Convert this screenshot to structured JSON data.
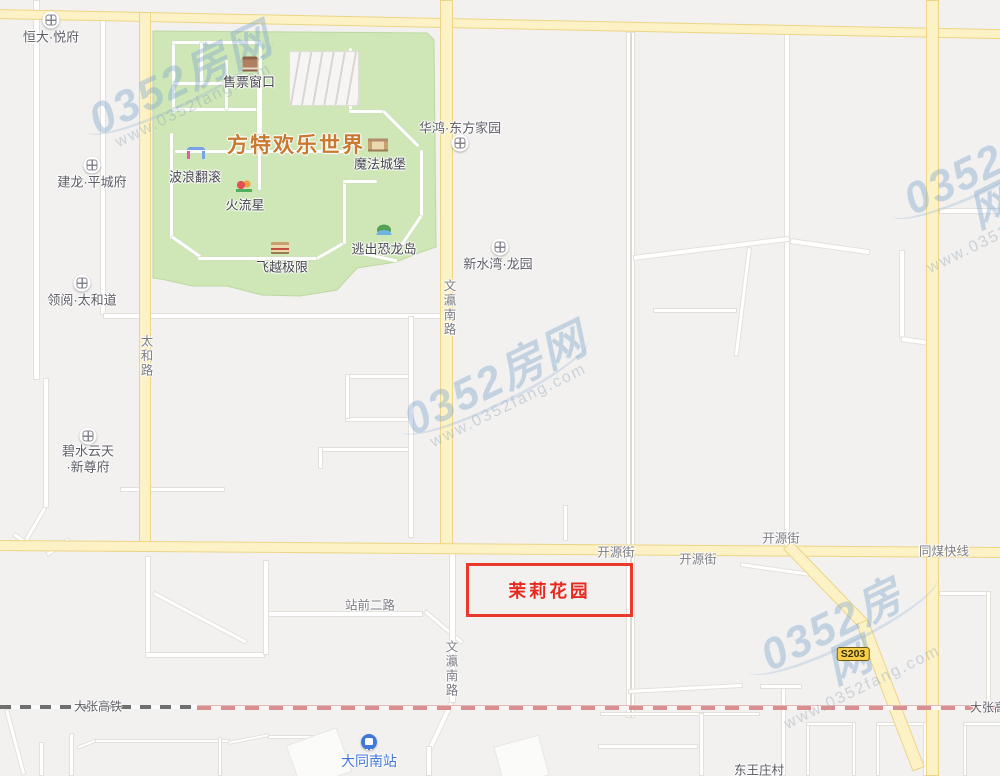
{
  "map": {
    "width": 1000,
    "height": 776,
    "colors": {
      "background": "#f2f1ef",
      "park_green": "#cfe7b6",
      "park_edge": "#bcd8a0",
      "road_yellow": "#fcf2c6",
      "road_yellow_edge": "#ecd587",
      "road_white": "#ffffff",
      "rail_dark": "#6f6f6f",
      "rail_pink": "#d98f8f",
      "highlight_red": "#e8392b",
      "poi_text": "#5c5c66",
      "road_text": "#7c7c84",
      "park_title_orange": "#c8792f",
      "station_blue": "#3f78d8",
      "watermark_blue": "#7da5cd"
    },
    "park": {
      "name": "fantawild-park-area",
      "polygon": "153,31 427,33 434,40 436,247 421,252 396,262 357,268 337,290 300,296 262,295 227,286 192,286 166,280 153,278",
      "parking": {
        "x": 289,
        "y": 51,
        "w": 68,
        "h": 53
      },
      "paths": [
        {
          "d": "v",
          "x": 172,
          "y": 41,
          "l": 72,
          "t": 3
        },
        {
          "d": "h",
          "x": 172,
          "y": 41,
          "l": 90,
          "t": 3
        },
        {
          "d": "v",
          "x": 259,
          "y": 41,
          "l": 48,
          "t": 3
        },
        {
          "d": "h",
          "x": 172,
          "y": 108,
          "l": 90,
          "t": 3
        },
        {
          "d": "v",
          "x": 200,
          "y": 42,
          "l": 42,
          "t": 3
        },
        {
          "d": "h",
          "x": 172,
          "y": 82,
          "l": 56,
          "t": 3
        },
        {
          "d": "v",
          "x": 225,
          "y": 60,
          "l": 50,
          "t": 3
        },
        {
          "d": "v",
          "x": 257,
          "y": 86,
          "l": 48,
          "t": 5
        },
        {
          "d": "v",
          "x": 349,
          "y": 48,
          "l": 64,
          "t": 3
        },
        {
          "d": "h",
          "x": 349,
          "y": 110,
          "l": 34,
          "t": 3
        },
        {
          "d": "v",
          "x": 382,
          "y": 112,
          "l": 50,
          "t": 3,
          "deg": -45
        },
        {
          "d": "v",
          "x": 170,
          "y": 133,
          "l": 106,
          "t": 3
        },
        {
          "d": "v",
          "x": 171,
          "y": 238,
          "l": 35,
          "t": 3,
          "deg": -55
        },
        {
          "d": "h",
          "x": 198,
          "y": 257,
          "l": 120,
          "t": 3
        },
        {
          "d": "h",
          "x": 317,
          "y": 257,
          "l": 30,
          "t": 3,
          "deg": -30
        },
        {
          "d": "v",
          "x": 343,
          "y": 180,
          "l": 64,
          "t": 3
        },
        {
          "d": "h",
          "x": 343,
          "y": 180,
          "l": 34,
          "t": 3
        },
        {
          "d": "v",
          "x": 420,
          "y": 150,
          "l": 67,
          "t": 3
        },
        {
          "d": "v",
          "x": 420,
          "y": 215,
          "l": 39,
          "t": 3,
          "deg": 34
        },
        {
          "d": "h",
          "x": 362,
          "y": 252,
          "l": 36,
          "t": 3,
          "deg": 12
        },
        {
          "d": "h",
          "x": 175,
          "y": 150,
          "l": 175,
          "t": 3
        },
        {
          "d": "v",
          "x": 258,
          "y": 150,
          "l": 40,
          "t": 3
        }
      ]
    },
    "roads_yellow": [
      {
        "name": "north-road",
        "d": "h",
        "x": -4,
        "y": 9,
        "l": 1010,
        "t": 10,
        "deg": 1.15
      },
      {
        "name": "taihe-road",
        "d": "v",
        "x": 139,
        "y": 12,
        "l": 536,
        "t": 12
      },
      {
        "name": "wenying-south-road",
        "d": "v",
        "x": 440,
        "y": 0,
        "l": 551,
        "t": 13
      },
      {
        "name": "tongmei-express-road",
        "d": "v",
        "x": 926,
        "y": 0,
        "l": 776,
        "t": 13
      },
      {
        "name": "kaiyuan-street",
        "d": "h",
        "x": -4,
        "y": 540,
        "l": 1010,
        "t": 11,
        "deg": 0.4
      },
      {
        "name": "s203-road-upper",
        "d": "v",
        "x": 783,
        "y": 549,
        "l": 110,
        "t": 12,
        "deg": -44
      },
      {
        "name": "s203-road-lower",
        "d": "v",
        "x": 856,
        "y": 624,
        "l": 158,
        "t": 13,
        "deg": -21
      }
    ],
    "roads_white": [
      {
        "d": "v",
        "x": 33,
        "y": 0,
        "l": 380,
        "t": 7
      },
      {
        "d": "v",
        "x": 100,
        "y": 20,
        "l": 295,
        "t": 6
      },
      {
        "d": "h",
        "x": 103,
        "y": 313,
        "l": 340,
        "t": 6
      },
      {
        "d": "v",
        "x": 43,
        "y": 378,
        "l": 130,
        "t": 6
      },
      {
        "d": "v",
        "x": 43,
        "y": 506,
        "l": 46,
        "t": 5,
        "deg": 30
      },
      {
        "d": "h",
        "x": 120,
        "y": 487,
        "l": 105,
        "t": 5
      },
      {
        "d": "v",
        "x": 12,
        "y": 536,
        "l": 28,
        "t": 5,
        "deg": -55
      },
      {
        "d": "v",
        "x": 68,
        "y": 537,
        "l": 28,
        "t": 5,
        "deg": 55
      },
      {
        "d": "v",
        "x": 408,
        "y": 316,
        "l": 222,
        "t": 6
      },
      {
        "d": "h",
        "x": 345,
        "y": 374,
        "l": 64,
        "t": 5
      },
      {
        "d": "h",
        "x": 345,
        "y": 417,
        "l": 64,
        "t": 5
      },
      {
        "d": "v",
        "x": 345,
        "y": 374,
        "l": 45,
        "t": 5
      },
      {
        "d": "h",
        "x": 318,
        "y": 447,
        "l": 91,
        "t": 5
      },
      {
        "d": "v",
        "x": 318,
        "y": 447,
        "l": 22,
        "t": 5
      },
      {
        "d": "v",
        "x": 563,
        "y": 505,
        "l": 36,
        "t": 5
      },
      {
        "d": "v",
        "x": 626,
        "y": 32,
        "l": 686,
        "t": 9,
        "dbl": true
      },
      {
        "d": "v",
        "x": 784,
        "y": 33,
        "l": 520,
        "t": 6
      },
      {
        "d": "h",
        "x": 633,
        "y": 255,
        "l": 158,
        "t": 6,
        "deg": -7
      },
      {
        "d": "v",
        "x": 747,
        "y": 247,
        "l": 110,
        "t": 5,
        "deg": 7
      },
      {
        "d": "h",
        "x": 653,
        "y": 308,
        "l": 84,
        "t": 5
      },
      {
        "d": "h",
        "x": 790,
        "y": 238,
        "l": 81,
        "t": 6,
        "deg": 8
      },
      {
        "d": "v",
        "x": 899,
        "y": 250,
        "l": 88,
        "t": 6
      },
      {
        "d": "h",
        "x": 901,
        "y": 336,
        "l": 33,
        "t": 6,
        "deg": 8
      },
      {
        "d": "h",
        "x": 939,
        "y": 208,
        "l": 61,
        "t": 6
      },
      {
        "d": "h",
        "x": 939,
        "y": 591,
        "l": 50,
        "t": 5
      },
      {
        "d": "v",
        "x": 986,
        "y": 591,
        "l": 117,
        "t": 5
      },
      {
        "d": "h",
        "x": 740,
        "y": 562,
        "l": 71,
        "t": 5,
        "deg": 8
      },
      {
        "d": "h",
        "x": 628,
        "y": 689,
        "l": 115,
        "t": 5,
        "deg": -3
      },
      {
        "d": "h",
        "x": 600,
        "y": 712,
        "l": 160,
        "t": 4
      },
      {
        "d": "v",
        "x": 699,
        "y": 713,
        "l": 63,
        "t": 5
      },
      {
        "d": "h",
        "x": 598,
        "y": 744,
        "l": 100,
        "t": 5
      },
      {
        "d": "v",
        "x": 781,
        "y": 684,
        "l": 92,
        "t": 5
      },
      {
        "d": "h",
        "x": 760,
        "y": 684,
        "l": 42,
        "t": 5
      },
      {
        "d": "v",
        "x": 806,
        "y": 722,
        "l": 54,
        "t": 4
      },
      {
        "d": "h",
        "x": 806,
        "y": 722,
        "l": 48,
        "t": 4
      },
      {
        "d": "v",
        "x": 852,
        "y": 722,
        "l": 54,
        "t": 4
      },
      {
        "d": "v",
        "x": 876,
        "y": 722,
        "l": 54,
        "t": 4
      },
      {
        "d": "h",
        "x": 876,
        "y": 722,
        "l": 49,
        "t": 4
      },
      {
        "d": "v",
        "x": 923,
        "y": 722,
        "l": 54,
        "t": 4
      },
      {
        "d": "v",
        "x": 963,
        "y": 722,
        "l": 54,
        "t": 4
      },
      {
        "d": "h",
        "x": 963,
        "y": 722,
        "l": 40,
        "t": 4
      },
      {
        "d": "v",
        "x": 4,
        "y": 710,
        "l": 68,
        "t": 5,
        "deg": -15
      },
      {
        "d": "v",
        "x": 39,
        "y": 742,
        "l": 34,
        "t": 5
      },
      {
        "d": "v",
        "x": 69,
        "y": 733,
        "l": 43,
        "t": 5
      },
      {
        "d": "h",
        "x": 77,
        "y": 746,
        "l": 22,
        "t": 4,
        "deg": -22
      },
      {
        "d": "h",
        "x": 95,
        "y": 739,
        "l": 135,
        "t": 4
      },
      {
        "d": "h",
        "x": 228,
        "y": 741,
        "l": 42,
        "t": 4,
        "deg": -11
      },
      {
        "d": "h",
        "x": 268,
        "y": 735,
        "l": 62,
        "t": 4
      },
      {
        "d": "v",
        "x": 218,
        "y": 737,
        "l": 39,
        "t": 4
      },
      {
        "d": "v",
        "x": 145,
        "y": 556,
        "l": 98,
        "t": 6
      },
      {
        "d": "h",
        "x": 145,
        "y": 652,
        "l": 120,
        "t": 6
      },
      {
        "d": "v",
        "x": 152,
        "y": 595,
        "l": 106,
        "t": 5,
        "deg": -62
      },
      {
        "d": "h",
        "x": 263,
        "y": 611,
        "l": 160,
        "t": 6
      },
      {
        "d": "v",
        "x": 263,
        "y": 560,
        "l": 95,
        "t": 6
      },
      {
        "d": "v",
        "x": 423,
        "y": 613,
        "l": 50,
        "t": 5,
        "deg": -50
      },
      {
        "d": "v",
        "x": 449,
        "y": 553,
        "l": 150,
        "t": 7
      },
      {
        "d": "v",
        "x": 449,
        "y": 701,
        "l": 52,
        "t": 6,
        "deg": 25
      },
      {
        "d": "v",
        "x": 426,
        "y": 746,
        "l": 30,
        "t": 6
      }
    ],
    "plazas": [
      {
        "x": 292,
        "y": 735,
        "w": 52,
        "h": 45,
        "deg": -20
      },
      {
        "x": 498,
        "y": 740,
        "w": 45,
        "h": 40,
        "deg": -15
      }
    ],
    "railway": {
      "name": "dazhang-high-speed-rail",
      "segments": [
        {
          "x": 0,
          "y": 705,
          "l": 197,
          "cls": "rail-dark"
        },
        {
          "x": 197,
          "y": 705,
          "l": 803,
          "cls": "rail-pink"
        }
      ]
    },
    "road_labels": [
      {
        "text": "太和路",
        "x": 146,
        "y": 356,
        "vertical": true
      },
      {
        "text": "文瀛南路",
        "x": 449,
        "y": 308,
        "vertical": true
      },
      {
        "text": "文瀛南路",
        "x": 451,
        "y": 669,
        "vertical": true
      },
      {
        "text": "开源街",
        "x": 616,
        "y": 551
      },
      {
        "text": "开源街",
        "x": 698,
        "y": 558
      },
      {
        "text": "开源街",
        "x": 781,
        "y": 537
      },
      {
        "text": "同煤快线",
        "x": 944,
        "y": 550
      },
      {
        "text": "站前二路",
        "x": 370,
        "y": 604
      },
      {
        "text": "大张高铁",
        "x": 98,
        "y": 706,
        "cls": "rail-t"
      },
      {
        "text": "大张高铁",
        "x": 994,
        "y": 707,
        "cls": "rail-t"
      },
      {
        "text": "东王庄村",
        "x": 759,
        "y": 769,
        "cls": "village-t"
      }
    ],
    "pois": [
      {
        "name": "hengda-yuefu",
        "label": "恒大·悦府",
        "icon": {
          "x": 51,
          "y": 20
        },
        "text": {
          "x": 51,
          "y": 36
        }
      },
      {
        "name": "jianlong-pingchengfu",
        "label": "建龙·平城府",
        "icon": {
          "x": 92,
          "y": 165
        },
        "text": {
          "x": 92,
          "y": 181
        }
      },
      {
        "name": "lingyue-taihedao",
        "label": "领阅·太和道",
        "icon": {
          "x": 82,
          "y": 283
        },
        "text": {
          "x": 82,
          "y": 299
        }
      },
      {
        "name": "bishuiyuntian-xinzunfu",
        "label": "碧水云天",
        "label2": "·新尊府",
        "icon": {
          "x": 88,
          "y": 436
        },
        "text": {
          "x": 88,
          "y": 450
        },
        "text2": {
          "x": 88,
          "y": 466
        }
      },
      {
        "name": "huahong-dongfangjiayuan",
        "label": "华鸿·东方家园",
        "icon": {
          "x": 460,
          "y": 143
        },
        "text": {
          "x": 460,
          "y": 127
        }
      },
      {
        "name": "xinshuiwan-longyuan",
        "label": "新水湾·龙园",
        "icon": {
          "x": 500,
          "y": 247
        },
        "text": {
          "x": 498,
          "y": 263
        }
      }
    ],
    "park_title": {
      "text": "方特欢乐世界",
      "x": 296,
      "y": 144
    },
    "attractions": [
      {
        "name": "ticket-office",
        "label": "售票窗口",
        "type": "ticket",
        "icon": {
          "x": 250,
          "y": 64
        },
        "text": {
          "x": 249,
          "y": 81
        }
      },
      {
        "name": "wave-ride",
        "label": "波浪翻滚",
        "type": "gate",
        "icon": {
          "x": 196,
          "y": 153
        },
        "text": {
          "x": 195,
          "y": 176
        }
      },
      {
        "name": "fire-meteor",
        "label": "火流星",
        "type": "coaster",
        "icon": {
          "x": 244,
          "y": 186
        },
        "text": {
          "x": 245,
          "y": 204
        }
      },
      {
        "name": "magic-castle",
        "label": "魔法城堡",
        "type": "castle",
        "icon": {
          "x": 378,
          "y": 145
        },
        "text": {
          "x": 380,
          "y": 163
        }
      },
      {
        "name": "dino-island-escape",
        "label": "逃出恐龙岛",
        "type": "island",
        "icon": {
          "x": 384,
          "y": 229
        },
        "text": {
          "x": 384,
          "y": 248
        }
      },
      {
        "name": "flight-extreme",
        "label": "飞越极限",
        "type": "building",
        "icon": {
          "x": 280,
          "y": 248
        },
        "text": {
          "x": 282,
          "y": 266
        }
      }
    ],
    "station": {
      "name": "datong-south-station",
      "label": "大同南站",
      "icon": {
        "x": 369,
        "y": 742
      },
      "text": {
        "x": 369,
        "y": 761
      }
    },
    "badge": {
      "text": "S203",
      "x": 853,
      "y": 654
    },
    "highlight": {
      "label": "茉莉花园",
      "x": 466,
      "y": 563,
      "w": 161,
      "h": 48
    },
    "watermark": {
      "text": "0352房网",
      "subtext": "www.0352fang.com",
      "positions": [
        {
          "x": 185,
          "y": 88
        },
        {
          "x": 500,
          "y": 388
        },
        {
          "x": 845,
          "y": 652
        },
        {
          "x": 988,
          "y": 196
        }
      ]
    }
  }
}
